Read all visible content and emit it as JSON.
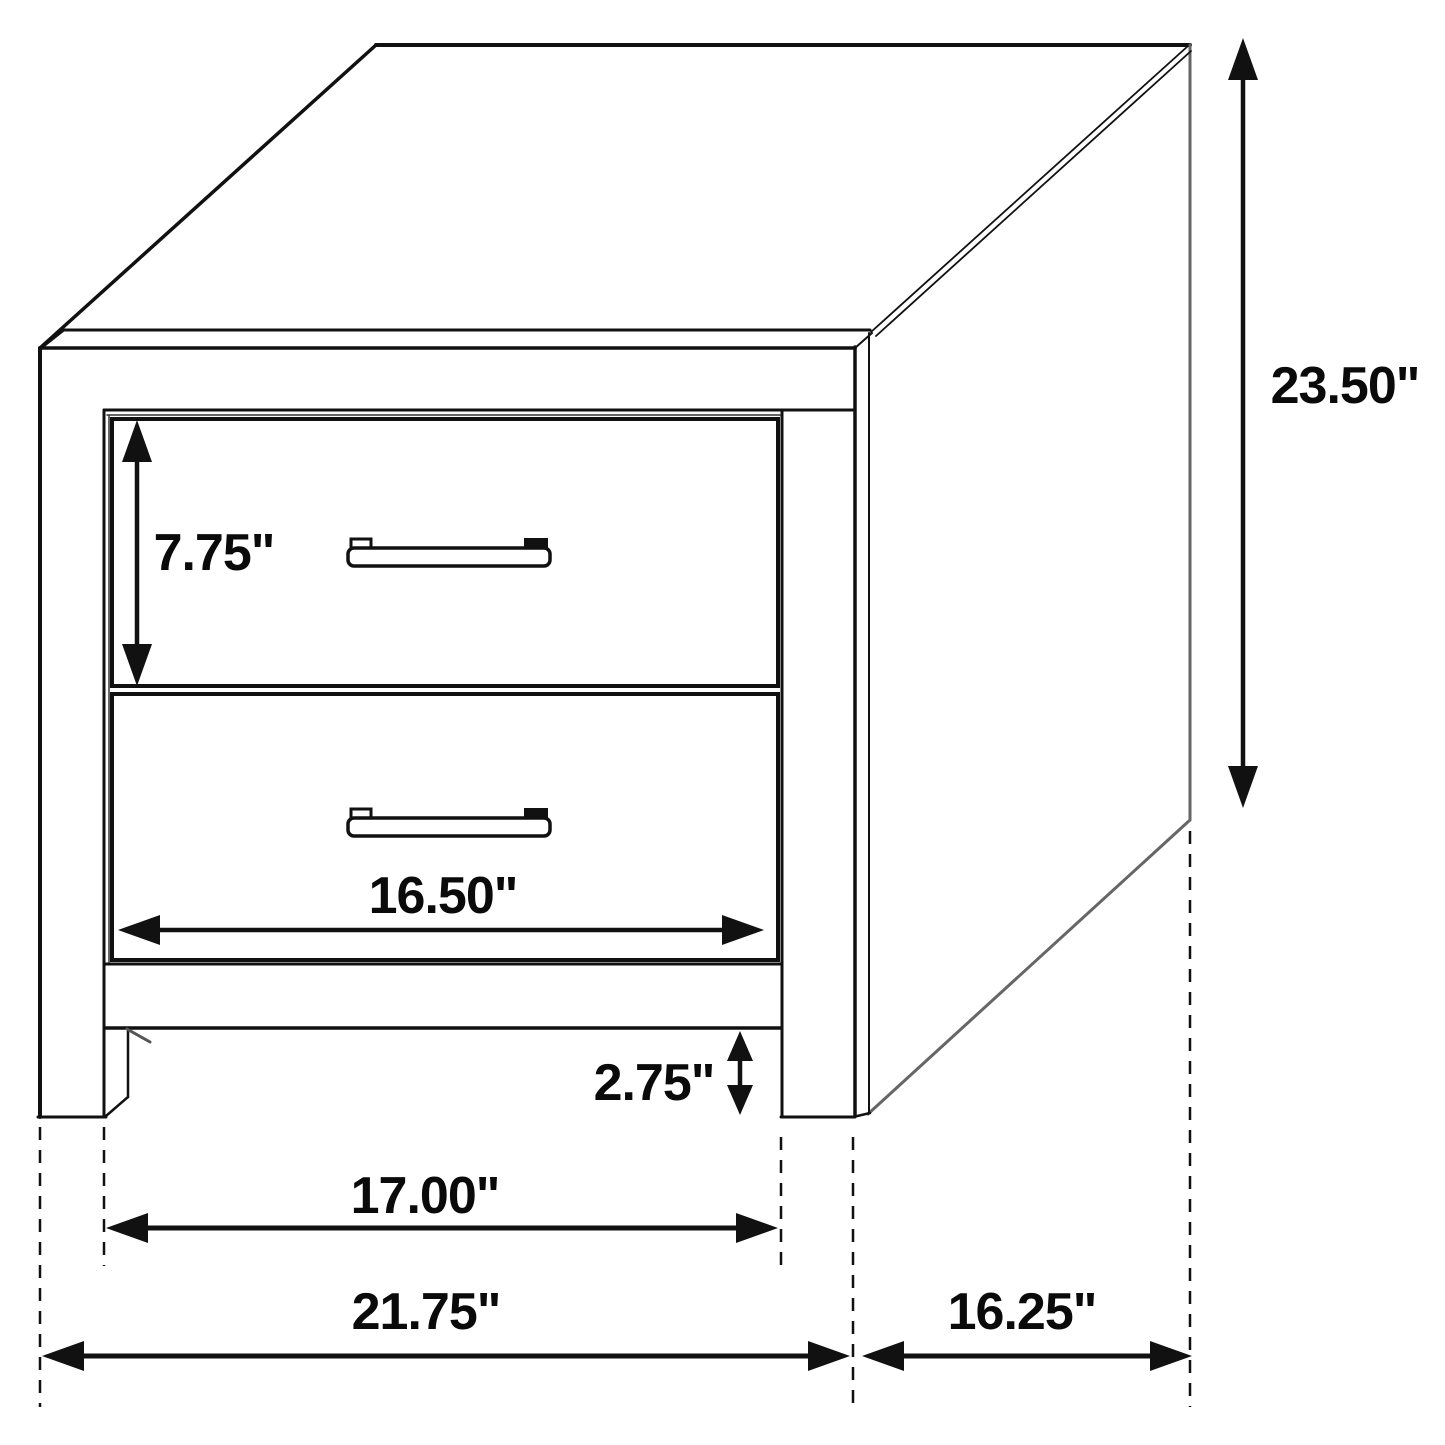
{
  "diagram": {
    "type": "furniture-dimension-diagram",
    "subject": "two-drawer nightstand line drawing",
    "unit": "inches",
    "colors": {
      "line": "#111111",
      "soft_line": "#666666",
      "text": "#0a0a0a",
      "background": "#ffffff"
    },
    "dimensions": {
      "drawer_height": {
        "label": "7.75\""
      },
      "overall_height": {
        "label": "23.50\""
      },
      "drawer_width": {
        "label": "16.50\""
      },
      "base_clearance": {
        "label": "2.75\""
      },
      "inner_width": {
        "label": "17.00\""
      },
      "overall_width": {
        "label": "21.75\""
      },
      "overall_depth": {
        "label": "16.25\""
      }
    }
  }
}
